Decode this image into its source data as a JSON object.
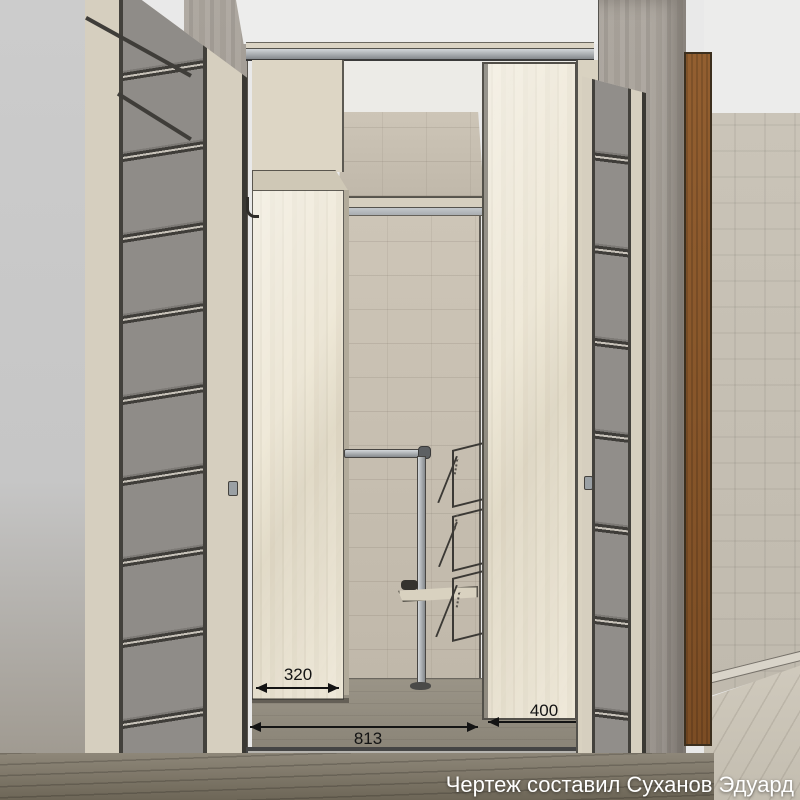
{
  "caption": "Чертеж составил Суханов Эдуард",
  "dimensions": {
    "left_cabinet_depth_mm": "320",
    "right_panel_depth_mm": "400",
    "opening_width_mm": "813"
  },
  "colors": {
    "caption": "#ffffff",
    "dim": "#141414",
    "cream": "#d6cfbf",
    "wood": "#eae3d1",
    "concrete": "#a49e96",
    "backwall": "#c8c0b2",
    "glass": "#8f8c88",
    "brown_door": "#8a5a2c",
    "track_metal": "#9aa0a6",
    "ceiling": "#ededec",
    "white_wall": "#ececeb",
    "floor_hall": "#837c6e",
    "floor_room": "#cbc5b8",
    "floor_inner": "#938d80",
    "wallpaper": "#c6c0b4"
  }
}
